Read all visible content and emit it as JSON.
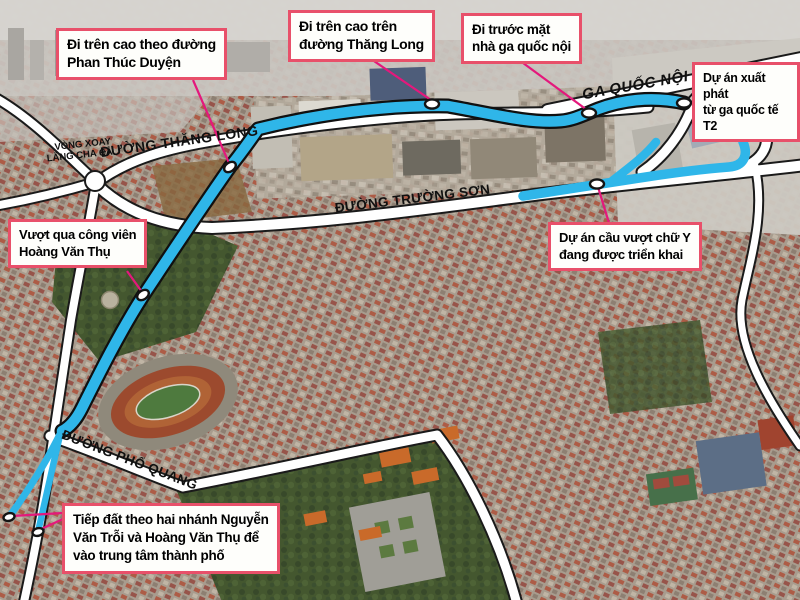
{
  "figure": {
    "type": "annotated-satellite-route-map",
    "colors": {
      "route_blue": "#2fb6e9",
      "leader_pink": "#e4187c",
      "callout_border": "#e8506a",
      "road_fill": "#ffffff",
      "road_casing": "#1a1a1a",
      "marker_fill": "#ffffff"
    },
    "callouts": [
      {
        "id": "elevated-phan-thuc-duyen",
        "text": "Đi trên cao theo đường\nPhan Thúc Duyện"
      },
      {
        "id": "elevated-thang-long",
        "text": "Đi trên cao trên\nđường Thăng Long"
      },
      {
        "id": "front-domestic-terminal",
        "text": "Đi trước mặt\nnhà ga quốc nội"
      },
      {
        "id": "start-international-t2",
        "text": "Dự án xuất phát\ntừ ga quốc tế T2"
      },
      {
        "id": "cross-hoang-van-thu-park",
        "text": "Vượt qua công viên\nHoàng Văn Thụ"
      },
      {
        "id": "y-flyover-project",
        "text": "Dự án cầu vượt chữ Y\nđang được triển khai"
      },
      {
        "id": "landing-two-branches",
        "text": "Tiếp đất theo hai nhánh Nguyễn\nVăn Trỗi và Hoàng Văn Thụ để\nvào trung tâm thành phố"
      }
    ],
    "road_labels": {
      "thang_long": "ĐƯỜNG THĂNG LONG",
      "vong_xoay_line1": "VÒNG XOAY",
      "vong_xoay_line2": "LĂNG CHA CẢ",
      "ga_quoc_noi": "GA QUỐC NỘI",
      "truong_son": "ĐƯỜNG TRƯỜNG SƠN",
      "pho_quang": "ĐƯỜNG PHỔ QUANG"
    }
  }
}
